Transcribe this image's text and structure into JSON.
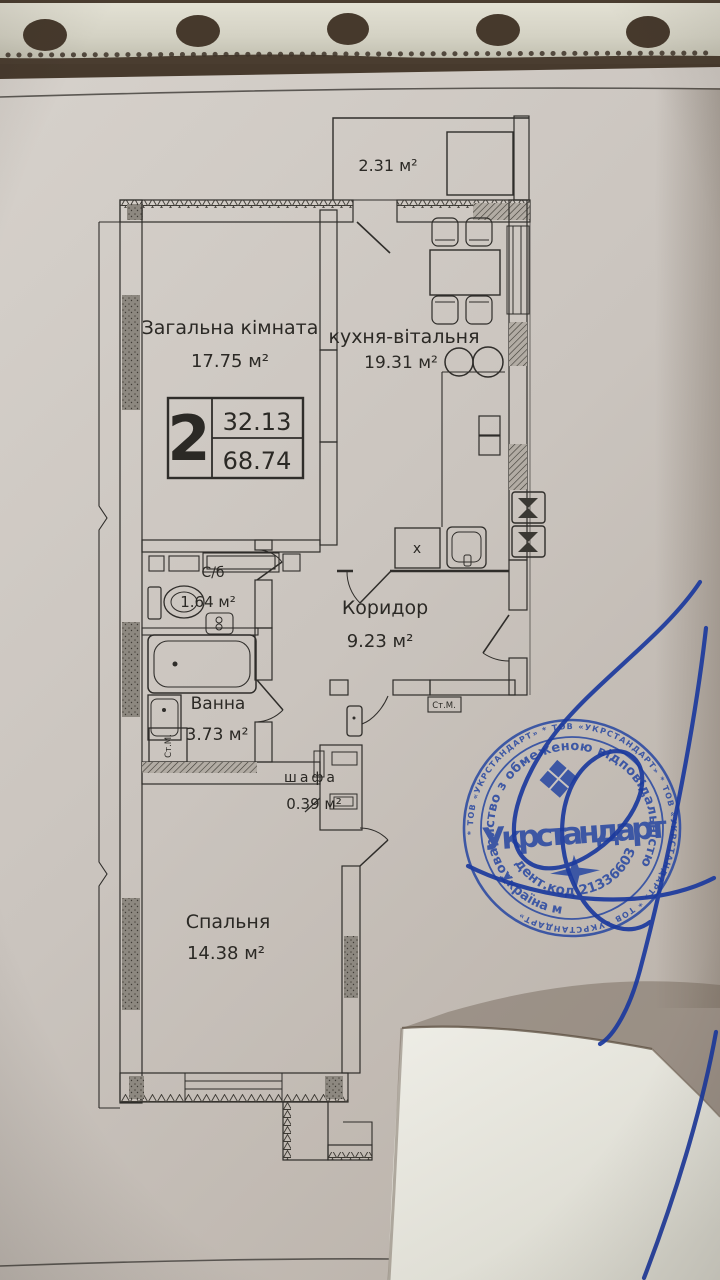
{
  "plan": {
    "balcony": {
      "area": "2.31 м²"
    },
    "living": {
      "label": "Загальна кімната",
      "area": "17.75 м²"
    },
    "kitchen": {
      "label": "кухня-вітальня",
      "area": "19.31 м²"
    },
    "wc": {
      "label": "С/б",
      "area": "1.64 м²"
    },
    "corridor": {
      "label": "Коридор",
      "area": "9.23 м²"
    },
    "bath": {
      "label": "Ванна",
      "area": "3.73 м²"
    },
    "closet": {
      "label": "шафа",
      "area": "0.39 м²"
    },
    "bedroom": {
      "label": "Спальня",
      "area": "14.38 м²"
    },
    "info_box": {
      "room_count": "2",
      "living_area": "32.13",
      "total_area": "68.74"
    },
    "marks": {
      "washer_bath": "Ст.М.",
      "washer_hall": "Ст.М.",
      "x_mark": "x"
    }
  },
  "stamp": {
    "ring_text": "* ТОВ «УКРСТАНДАРТ» * ТОВ «УКРСТАНДАРТ» * ТОВ «УКРСТАНДАРТ» * ТОВ «УКРСТАНДАРТ»",
    "org_type_arc": "Товариство з обмеженою відповідальністю",
    "org_name": "Укрстандарт",
    "id_code_arc": "Ідент.код 21336603",
    "country_arc": "Україна м",
    "ink_color": "#2b4aa2"
  },
  "signature": {
    "ink_color": "#1c3a9e"
  }
}
